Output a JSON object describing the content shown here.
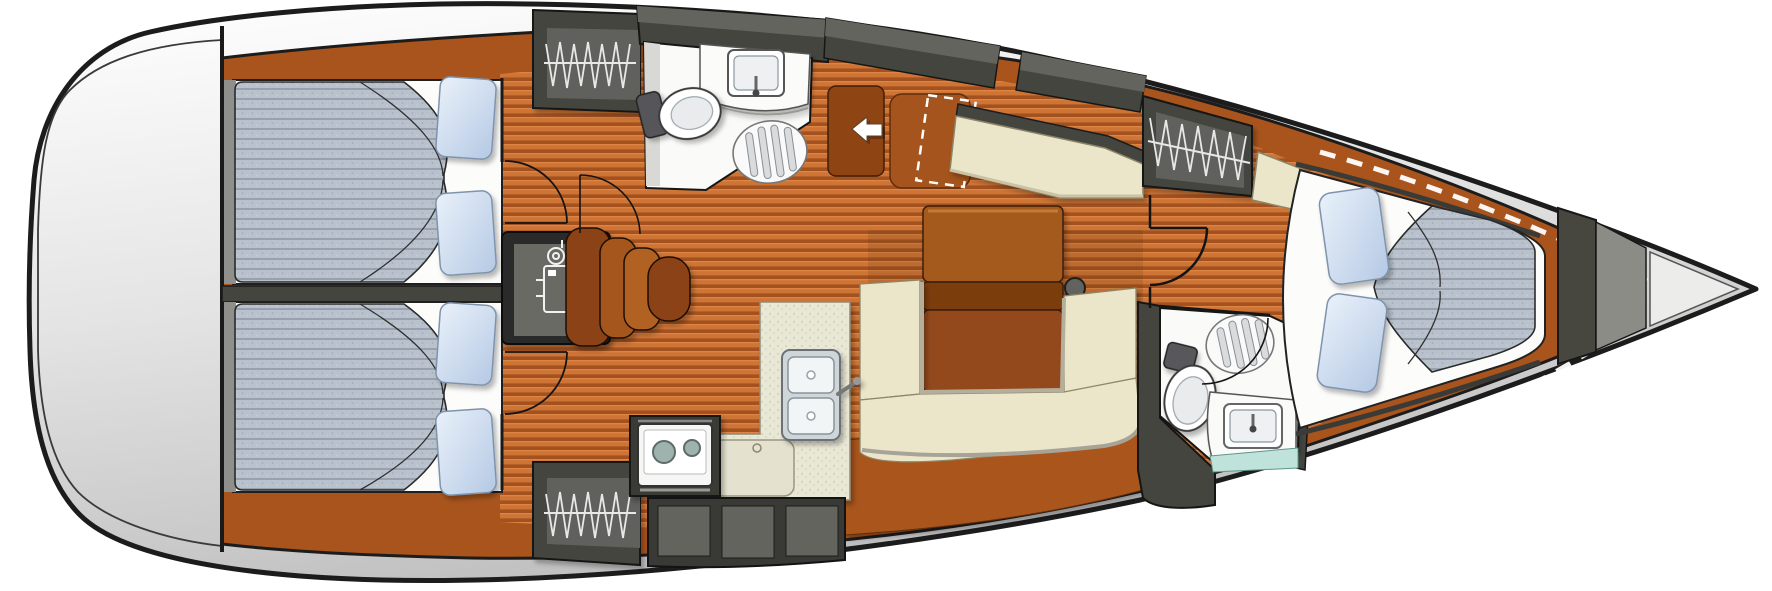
{
  "diagram": {
    "type": "sailboat-interior-floor-plan",
    "orientation": "bow-right",
    "visible_text": []
  },
  "palette": {
    "hull_stroke": "#1c1c1c",
    "deck_light": "#fdfdfd",
    "deck_dark": "#c2c2c2",
    "trim_brown": "#a9541d",
    "wood_base": "#ce7536",
    "wood_dark": "#a3521f",
    "wood_light": "#de8546",
    "wood_shade": "#50280e",
    "wall_dark": "#45453f",
    "wall_mid": "#64645e",
    "locker_panel": "#61615b",
    "engine_panel": "#6b6b65",
    "white": "#fcfcfb",
    "fixture_white": "#fafaf8",
    "mattress": "#b9c2cc",
    "mattress_line": "#97a2ae",
    "pillow_light": "#e3edf8",
    "pillow_dark": "#b5c9e4",
    "cream": "#ebe5ca",
    "cream_edge": "#8e8668",
    "counter": "#e9e7d6",
    "counter_dot": "#cbc7ab",
    "table_top": "#a35a1e",
    "table_leaf": "#7c3c0f",
    "table_lower": "#94491a",
    "step_dark": "#8a4312",
    "step_mid": "#a4571e",
    "step_light": "#b16223",
    "seat_brown": "#a4541c",
    "hatch_brown": "#8f4414",
    "teal": "#bfe2da",
    "metal": "#cfd6da",
    "burner": "#9fb3ae",
    "arrow_white": "#ffffff",
    "dash_white": "#ffffff",
    "hanger_white": "#e8e8e8",
    "mast_gray": "#62625e"
  },
  "regions": [
    {
      "id": "stern-deck",
      "name": "Stern deck"
    },
    {
      "id": "aft-cabin-port",
      "name": "Aft cabin port",
      "furniture": [
        "double-berth",
        "mattress",
        "pillows",
        "hanging-locker"
      ]
    },
    {
      "id": "aft-cabin-starboard",
      "name": "Aft cabin starboard",
      "furniture": [
        "double-berth",
        "mattress",
        "pillows",
        "hanging-locker"
      ]
    },
    {
      "id": "engine-compartment",
      "name": "Engine compartment",
      "furniture": [
        "engine",
        "companionway-steps"
      ]
    },
    {
      "id": "aft-head",
      "name": "Aft head port",
      "furniture": [
        "toilet",
        "washbasin",
        "shower-grate",
        "door"
      ]
    },
    {
      "id": "companionway",
      "name": "Companionway entrance",
      "furniture": [
        "entry-arrow",
        "cockpit-seat",
        "dashed-hatch-outline"
      ]
    },
    {
      "id": "nav-station",
      "name": "Navigation station",
      "furniture": [
        "chart-table",
        "nav-seat"
      ]
    },
    {
      "id": "saloon",
      "name": "Saloon",
      "furniture": [
        "dining-table",
        "folding-leaf",
        "u-shaped-settee",
        "mast-post"
      ]
    },
    {
      "id": "galley",
      "name": "Galley",
      "furniture": [
        "two-burner-stove",
        "double-sink",
        "icebox-counter",
        "stowage-lockers"
      ]
    },
    {
      "id": "forward-head",
      "name": "Forward head starboard",
      "furniture": [
        "toilet",
        "washbasin",
        "shower-grate",
        "door"
      ]
    },
    {
      "id": "forward-cabin",
      "name": "Forward cabin",
      "furniture": [
        "v-berth",
        "mattress",
        "pillows",
        "hanging-locker",
        "seat"
      ]
    },
    {
      "id": "bow",
      "name": "Bow anchor locker",
      "furniture": [
        "deck-hatch-dashed-lines"
      ]
    }
  ]
}
